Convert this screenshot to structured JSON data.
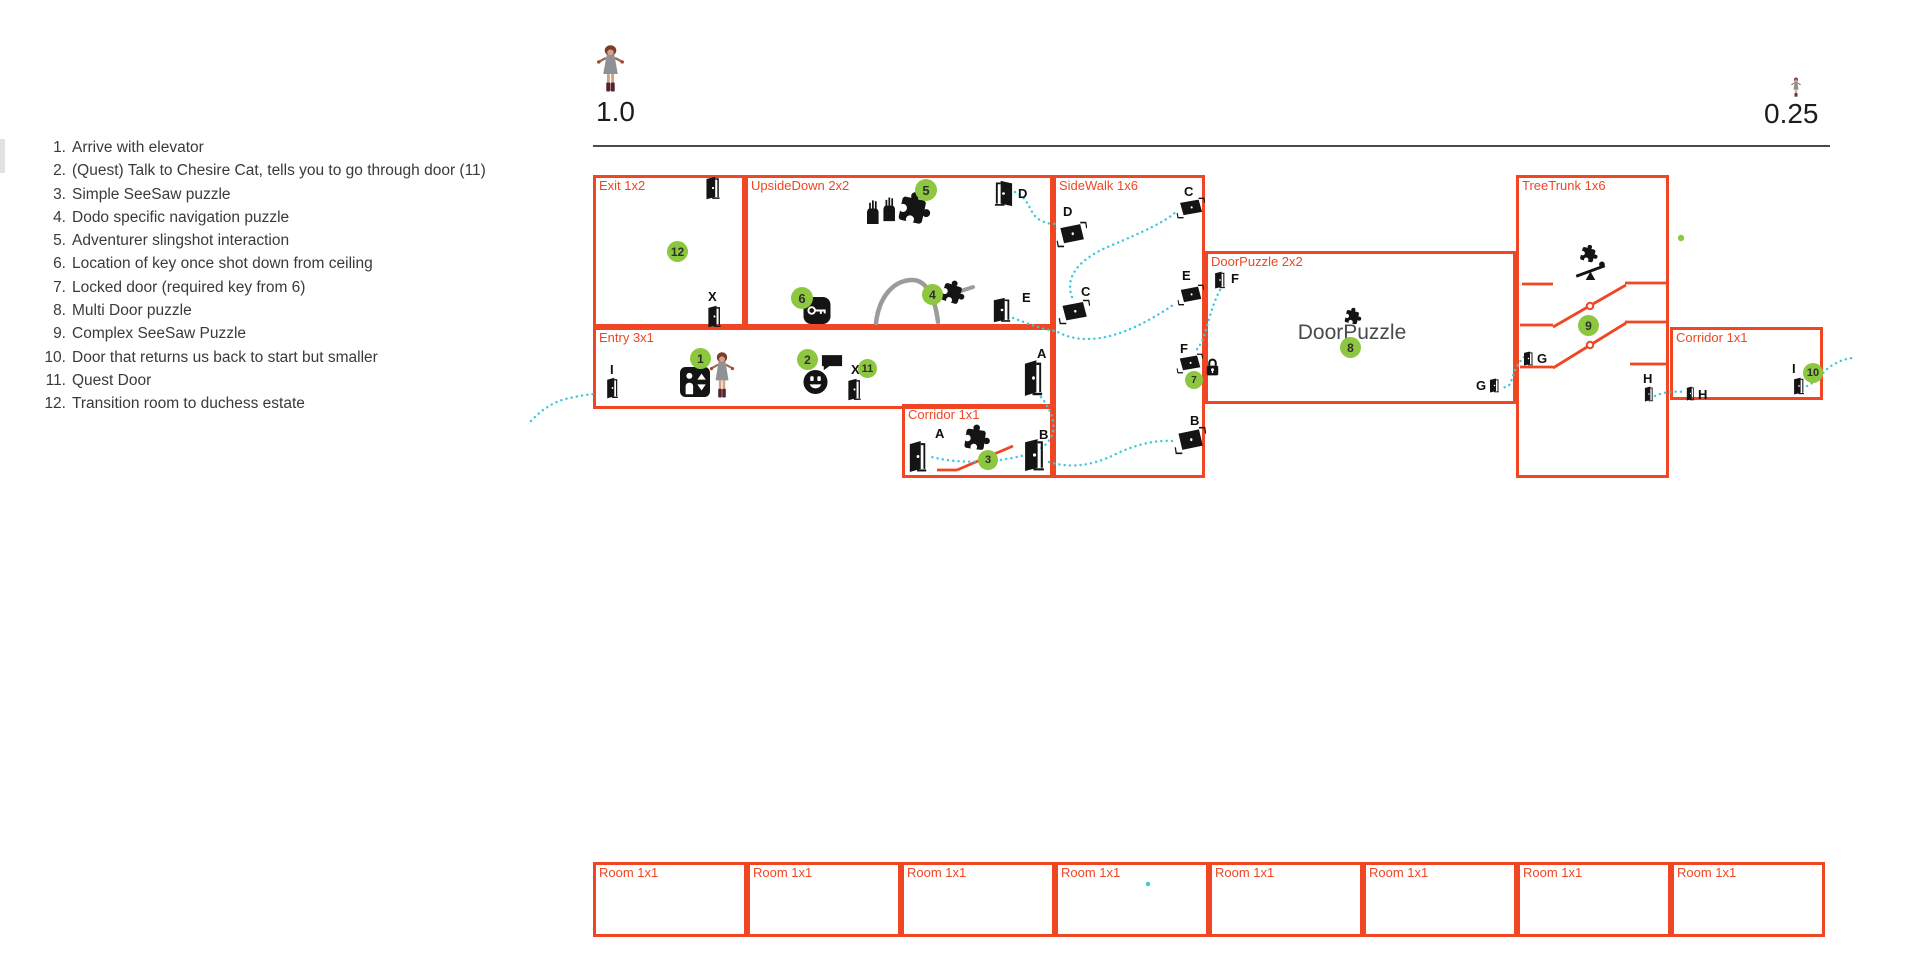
{
  "colors": {
    "room_border": "#f04623",
    "marker_green": "#8dc63f",
    "path_cyan": "#3cc9dc",
    "icon_black": "#141414",
    "gray_arc": "#9b9b9b",
    "rule_line": "#4a4a4a",
    "text_dark": "#3a3a3a"
  },
  "scales": [
    {
      "value": "1.0"
    },
    {
      "value": "0.25"
    }
  ],
  "legend": {
    "items": [
      "Arrive with elevator",
      "(Quest) Talk to Chesire Cat, tells you to go through door (11)",
      "Simple SeeSaw puzzle",
      "Dodo specific navigation puzzle",
      "Adventurer slingshot interaction",
      "Location of key once shot down from ceiling",
      "Locked door (required key from 6)",
      "Multi Door puzzle",
      "Complex SeeSaw Puzzle",
      "Door that returns us back to start but smaller",
      "Quest Door",
      "Transition room to duchess estate"
    ]
  },
  "map": {
    "rooms": [
      {
        "id": "exit",
        "label": "Exit 1x2",
        "x": 593,
        "y": 175,
        "w": 152,
        "h": 152
      },
      {
        "id": "upsidedown",
        "label": "UpsideDown 2x2",
        "x": 745,
        "y": 175,
        "w": 308,
        "h": 152
      },
      {
        "id": "sidewalk",
        "label": "SideWalk 1x6",
        "x": 1053,
        "y": 175,
        "w": 152,
        "h": 303
      },
      {
        "id": "entry",
        "label": "Entry 3x1",
        "x": 593,
        "y": 327,
        "w": 460,
        "h": 82
      },
      {
        "id": "corridor-3",
        "label": "Corridor 1x1",
        "x": 902,
        "y": 404,
        "w": 151,
        "h": 74
      },
      {
        "id": "doorpuzzle",
        "label": "DoorPuzzle 2x2",
        "x": 1205,
        "y": 251,
        "w": 311,
        "h": 153
      },
      {
        "id": "treetrunk",
        "label": "TreeTrunk 1x6",
        "x": 1516,
        "y": 175,
        "w": 153,
        "h": 303
      },
      {
        "id": "corridor-10",
        "label": "Corridor 1x1",
        "x": 1670,
        "y": 327,
        "w": 153,
        "h": 73
      },
      {
        "id": "room-b1",
        "label": "Room 1x1",
        "x": 593,
        "y": 862,
        "w": 154,
        "h": 75
      },
      {
        "id": "room-b2",
        "label": "Room 1x1",
        "x": 747,
        "y": 862,
        "w": 154,
        "h": 75
      },
      {
        "id": "room-b3",
        "label": "Room 1x1",
        "x": 901,
        "y": 862,
        "w": 154,
        "h": 75
      },
      {
        "id": "room-b4",
        "label": "Room 1x1",
        "x": 1055,
        "y": 862,
        "w": 154,
        "h": 75
      },
      {
        "id": "room-b5",
        "label": "Room 1x1",
        "x": 1209,
        "y": 862,
        "w": 154,
        "h": 75
      },
      {
        "id": "room-b6",
        "label": "Room 1x1",
        "x": 1363,
        "y": 862,
        "w": 154,
        "h": 75
      },
      {
        "id": "room-b7",
        "label": "Room 1x1",
        "x": 1517,
        "y": 862,
        "w": 154,
        "h": 75
      },
      {
        "id": "room-b8",
        "label": "Room 1x1",
        "x": 1671,
        "y": 862,
        "w": 154,
        "h": 75
      }
    ],
    "center_texts": [
      {
        "text": "DoorPuzzle",
        "x": 1352,
        "y": 321
      }
    ],
    "doors": [
      {
        "letter": "",
        "type": "upright",
        "x": 705,
        "y": 176,
        "w": 16,
        "h": 24,
        "lx": 0,
        "ly": 0
      },
      {
        "letter": "X",
        "type": "upright",
        "x": 707,
        "y": 305,
        "w": 15,
        "h": 23,
        "lx": 708,
        "ly": 289
      },
      {
        "letter": "D",
        "type": "upright",
        "mirror": true,
        "x": 993,
        "y": 180,
        "w": 21,
        "h": 27,
        "lx": 1018,
        "ly": 186
      },
      {
        "letter": "E",
        "type": "upright",
        "x": 992,
        "y": 297,
        "w": 20,
        "h": 26,
        "lx": 1022,
        "ly": 290
      },
      {
        "letter": "I",
        "type": "upright",
        "x": 606,
        "y": 377,
        "w": 13,
        "h": 22,
        "lx": 610,
        "ly": 362
      },
      {
        "letter": "X",
        "type": "upright",
        "x": 847,
        "y": 378,
        "w": 15,
        "h": 23,
        "lx": 851,
        "ly": 362
      },
      {
        "letter": "A",
        "type": "upright",
        "x": 1023,
        "y": 359,
        "w": 21,
        "h": 38,
        "lx": 1037,
        "ly": 346
      },
      {
        "letter": "A",
        "type": "upright",
        "x": 908,
        "y": 440,
        "w": 20,
        "h": 33,
        "lx": 935,
        "ly": 426
      },
      {
        "letter": "B",
        "type": "upright",
        "x": 1023,
        "y": 438,
        "w": 23,
        "h": 34,
        "lx": 1039,
        "ly": 427
      },
      {
        "letter": "F",
        "type": "upright",
        "x": 1214,
        "y": 271,
        "w": 12,
        "h": 18,
        "lx": 1231,
        "ly": 271
      },
      {
        "letter": "G",
        "type": "upright",
        "x": 1489,
        "y": 378,
        "w": 11,
        "h": 15,
        "lx": 1476,
        "ly": 378
      },
      {
        "letter": "G",
        "type": "upright",
        "x": 1523,
        "y": 351,
        "w": 11,
        "h": 15,
        "lx": 1537,
        "ly": 351
      },
      {
        "letter": "H",
        "type": "upright",
        "x": 1644,
        "y": 386,
        "w": 10,
        "h": 16,
        "lx": 1643,
        "ly": 371
      },
      {
        "letter": "H",
        "type": "upright",
        "x": 1686,
        "y": 386,
        "w": 9,
        "h": 15,
        "lx": 1698,
        "ly": 387
      },
      {
        "letter": "I",
        "type": "upright",
        "x": 1793,
        "y": 377,
        "w": 12,
        "h": 18,
        "lx": 1792,
        "ly": 361
      },
      {
        "letter": "D",
        "type": "flat",
        "x": 1056,
        "y": 221,
        "w": 31,
        "h": 27,
        "lx": 1063,
        "ly": 204
      },
      {
        "letter": "C",
        "type": "flat",
        "x": 1176,
        "y": 197,
        "w": 29,
        "h": 22,
        "lx": 1184,
        "ly": 184
      },
      {
        "letter": "C",
        "type": "flat",
        "x": 1058,
        "y": 299,
        "w": 32,
        "h": 26,
        "lx": 1081,
        "ly": 284
      },
      {
        "letter": "E",
        "type": "flat",
        "x": 1177,
        "y": 284,
        "w": 27,
        "h": 22,
        "lx": 1182,
        "ly": 268
      },
      {
        "letter": "F",
        "type": "flat",
        "x": 1176,
        "y": 353,
        "w": 27,
        "h": 21,
        "lx": 1180,
        "ly": 341
      },
      {
        "letter": "B",
        "type": "flat",
        "x": 1174,
        "y": 426,
        "w": 32,
        "h": 29,
        "lx": 1190,
        "ly": 413
      }
    ],
    "markers": [
      {
        "n": "1",
        "x": 690,
        "y": 348,
        "d": 21
      },
      {
        "n": "2",
        "x": 797,
        "y": 349,
        "d": 21
      },
      {
        "n": "3",
        "x": 978,
        "y": 450,
        "d": 20
      },
      {
        "n": "4",
        "x": 922,
        "y": 284,
        "d": 21
      },
      {
        "n": "5",
        "x": 915,
        "y": 179,
        "d": 22
      },
      {
        "n": "6",
        "x": 791,
        "y": 287,
        "d": 22
      },
      {
        "n": "7",
        "x": 1185,
        "y": 371,
        "d": 18
      },
      {
        "n": "8",
        "x": 1340,
        "y": 337,
        "d": 21
      },
      {
        "n": "9",
        "x": 1578,
        "y": 315,
        "d": 21
      },
      {
        "n": "10",
        "x": 1803,
        "y": 363,
        "d": 20
      },
      {
        "n": "11",
        "x": 858,
        "y": 359,
        "d": 19
      },
      {
        "n": "12",
        "x": 667,
        "y": 241,
        "d": 21
      }
    ],
    "icons": [
      {
        "type": "girl",
        "name": "scale-girl-large-icon",
        "x": 596,
        "y": 44,
        "w": 29,
        "h": 48
      },
      {
        "type": "girl",
        "name": "scale-girl-small-icon",
        "x": 1791,
        "y": 77,
        "w": 10,
        "h": 20
      },
      {
        "type": "girl",
        "name": "player-character-icon",
        "x": 709,
        "y": 351,
        "w": 26,
        "h": 47
      },
      {
        "type": "elevator",
        "name": "elevator-icon",
        "x": 680,
        "y": 367,
        "w": 30,
        "h": 30
      },
      {
        "type": "smiley",
        "name": "cheshire-cat-talk-icon",
        "x": 803,
        "y": 369,
        "w": 25,
        "h": 26
      },
      {
        "type": "bubble",
        "name": "speech-bubble-icon",
        "x": 821,
        "y": 354,
        "w": 22,
        "h": 17
      },
      {
        "type": "key",
        "name": "key-icon",
        "x": 803,
        "y": 297,
        "w": 28,
        "h": 27
      },
      {
        "type": "hands",
        "name": "raised-hands-icon",
        "x": 866,
        "y": 196,
        "w": 30,
        "h": 28
      },
      {
        "type": "puzzle",
        "name": "puzzle-piece-icon",
        "x": 894,
        "y": 189,
        "w": 39,
        "h": 38,
        "rot": 12
      },
      {
        "type": "puzzle",
        "name": "puzzle-piece-icon",
        "x": 937,
        "y": 278,
        "w": 31,
        "h": 28,
        "rot": 18
      },
      {
        "type": "puzzle",
        "name": "puzzle-piece-icon",
        "x": 957,
        "y": 422,
        "w": 38,
        "h": 31,
        "rot": 8
      },
      {
        "type": "puzzle",
        "name": "puzzle-piece-icon",
        "x": 1342,
        "y": 306,
        "w": 21,
        "h": 20,
        "rot": 12
      },
      {
        "type": "puzzle",
        "name": "puzzle-piece-icon",
        "x": 1578,
        "y": 243,
        "w": 21,
        "h": 21,
        "rot": 15
      },
      {
        "type": "seesaw",
        "name": "seesaw-icon",
        "x": 1574,
        "y": 261,
        "w": 33,
        "h": 20
      },
      {
        "type": "lock",
        "name": "padlock-icon",
        "x": 1206,
        "y": 357,
        "w": 13,
        "h": 20
      }
    ],
    "red_lines": [
      [
        1522,
        284,
        1553,
        284
      ],
      [
        1625,
        283,
        1667,
        283
      ],
      [
        1553,
        327,
        1626,
        285
      ],
      [
        1520,
        325,
        1553,
        325
      ],
      [
        1625,
        322,
        1667,
        322
      ],
      [
        1553,
        368,
        1626,
        323
      ],
      [
        1520,
        367,
        1553,
        367
      ],
      [
        1630,
        364,
        1667,
        364
      ],
      [
        937,
        470,
        957,
        470
      ],
      [
        957,
        470,
        1013,
        446
      ]
    ],
    "pivots": [
      [
        1590,
        306
      ],
      [
        1590,
        345
      ]
    ],
    "gray_arc": {
      "d": "M876,323 C879,297 893,281 911,280 C927,279 935,298 938,322",
      "tick": "M961,291 L973,287"
    },
    "paths": [
      {
        "d": "M531,421 C544,407 558,400 570,398 C578,396 586,395 594,394"
      },
      {
        "d": "M1041,397 C1063,425 1055,447 1025,455 C996,463 958,464 932,457"
      },
      {
        "d": "M1049,462 C1076,470 1098,463 1118,453 C1140,443 1158,440 1173,441"
      },
      {
        "d": "M1015,192 C1032,200 1028,215 1042,221 C1048,224 1053,224 1057,224"
      },
      {
        "d": "M1072,297 C1063,273 1086,256 1110,246 C1145,231 1165,222 1177,211"
      },
      {
        "d": "M1013,318 C1032,325 1044,330 1056,331 C1092,352 1140,328 1176,303"
      },
      {
        "d": "M1220,290 C1212,305 1208,324 1204,336 C1201,344 1198,349 1194,352"
      },
      {
        "d": "M1524,357 C1517,364 1513,374 1511,382 C1509,387 1505,388 1501,387"
      },
      {
        "d": "M1655,396 C1663,392 1675,391 1686,392"
      },
      {
        "d": "M1807,386 C1818,381 1822,372 1831,366 C1839,361 1845,359 1852,358"
      }
    ],
    "dots": [
      {
        "x": 1681,
        "y": 238,
        "r": 3.2,
        "color": "green"
      },
      {
        "x": 1148,
        "y": 884,
        "r": 2.2,
        "color": "cyan"
      }
    ]
  }
}
